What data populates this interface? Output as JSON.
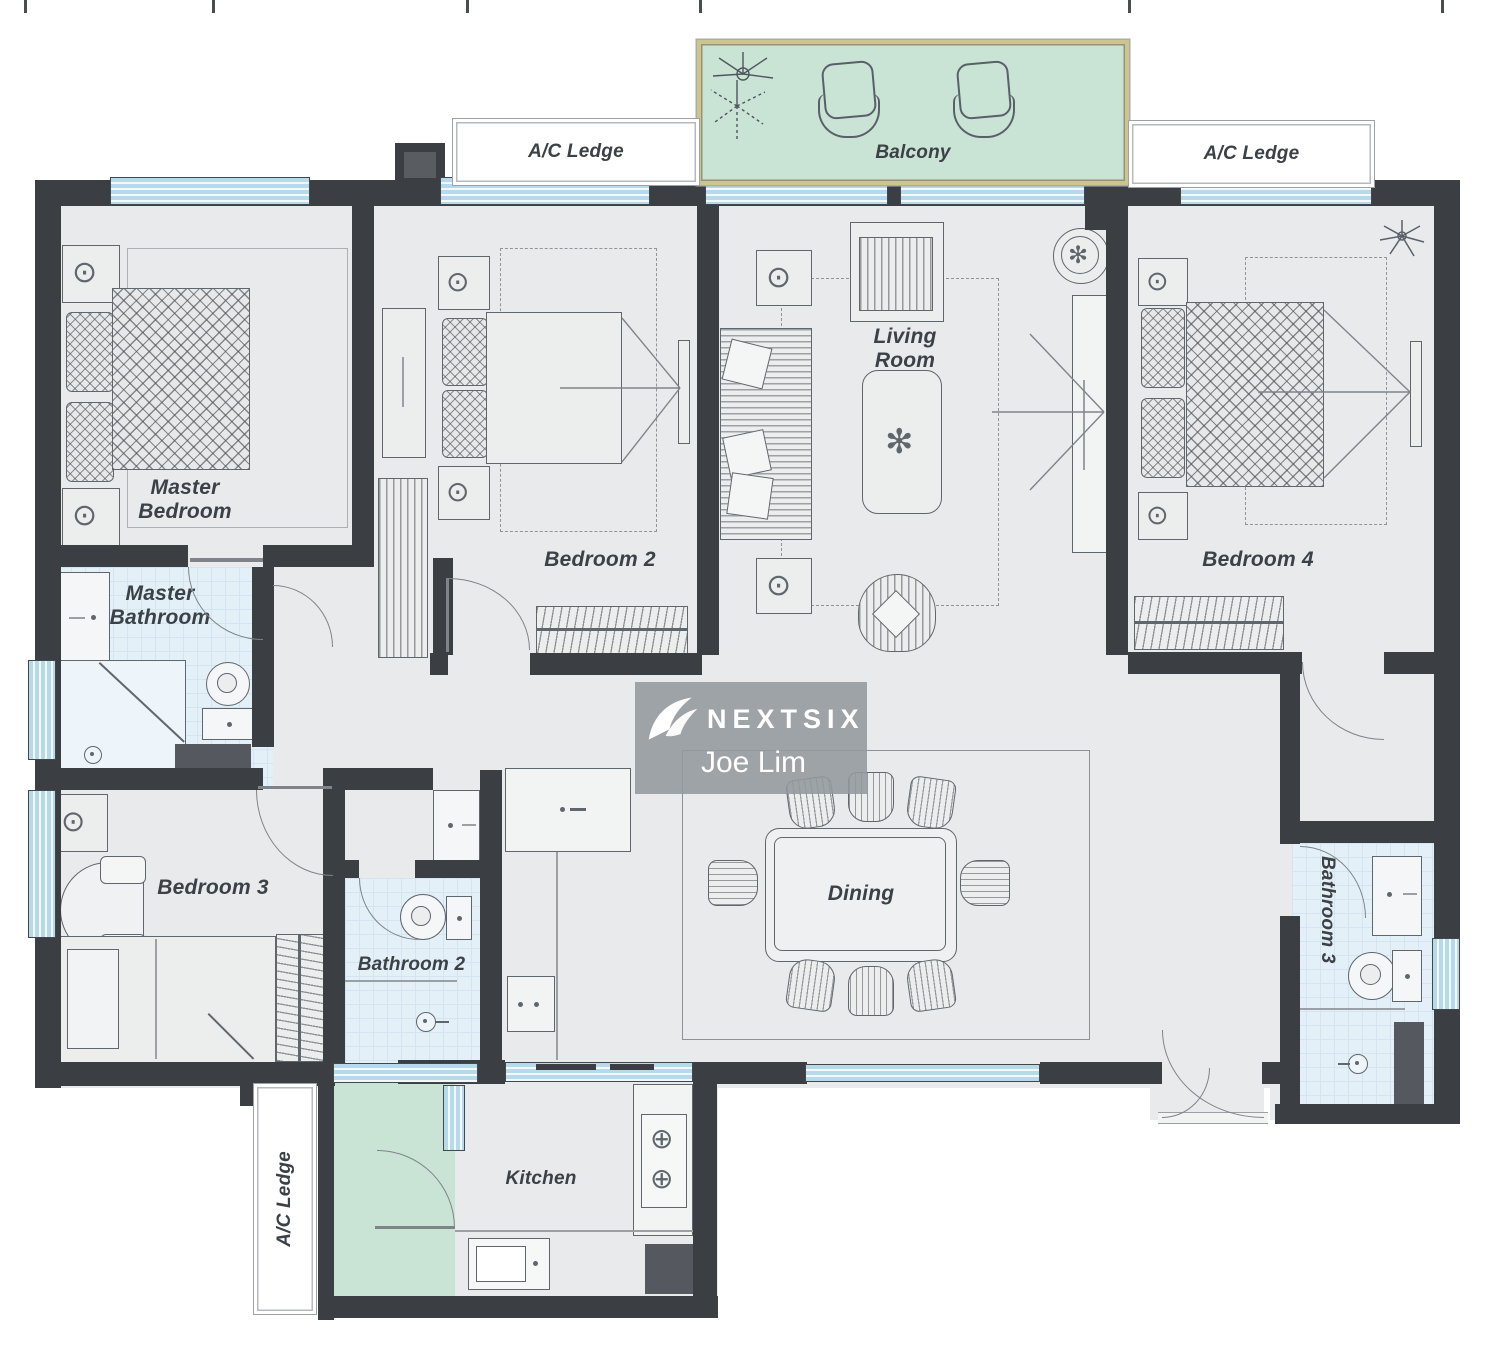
{
  "page": {
    "type": "apartment-floor-plan"
  },
  "watermark": {
    "brand": "NEXTSIX",
    "agent": "Joe Lim"
  },
  "labels": {
    "balcony": "Balcony",
    "ac_ledge_left": "A/C Ledge",
    "ac_ledge_right": "A/C Ledge",
    "ac_ledge_bottom": "A/C Ledge",
    "master_bedroom": "Master Bedroom",
    "master_bathroom": "Master Bathroom",
    "bedroom2": "Bedroom 2",
    "bedroom3": "Bedroom 3",
    "bedroom4": "Bedroom 4",
    "bathroom2": "Bathroom 2",
    "bathroom3": "Bathroom 3",
    "living_room": "Living Room",
    "dining": "Dining",
    "kitchen": "Kitchen"
  },
  "icons": {
    "lamp": "⊙",
    "burner": "⊕",
    "flower": "✻"
  },
  "colors": {
    "wall": "#3b3f43",
    "floor": "#e9eaec",
    "bathroom_floor": "#e4f0f8",
    "balcony_green": "#c9e4d4",
    "window_blue": "#b7daeb",
    "balcony_frame": "#cdc590",
    "label_text": "#3c4147",
    "watermark_bg": "#93989d"
  }
}
